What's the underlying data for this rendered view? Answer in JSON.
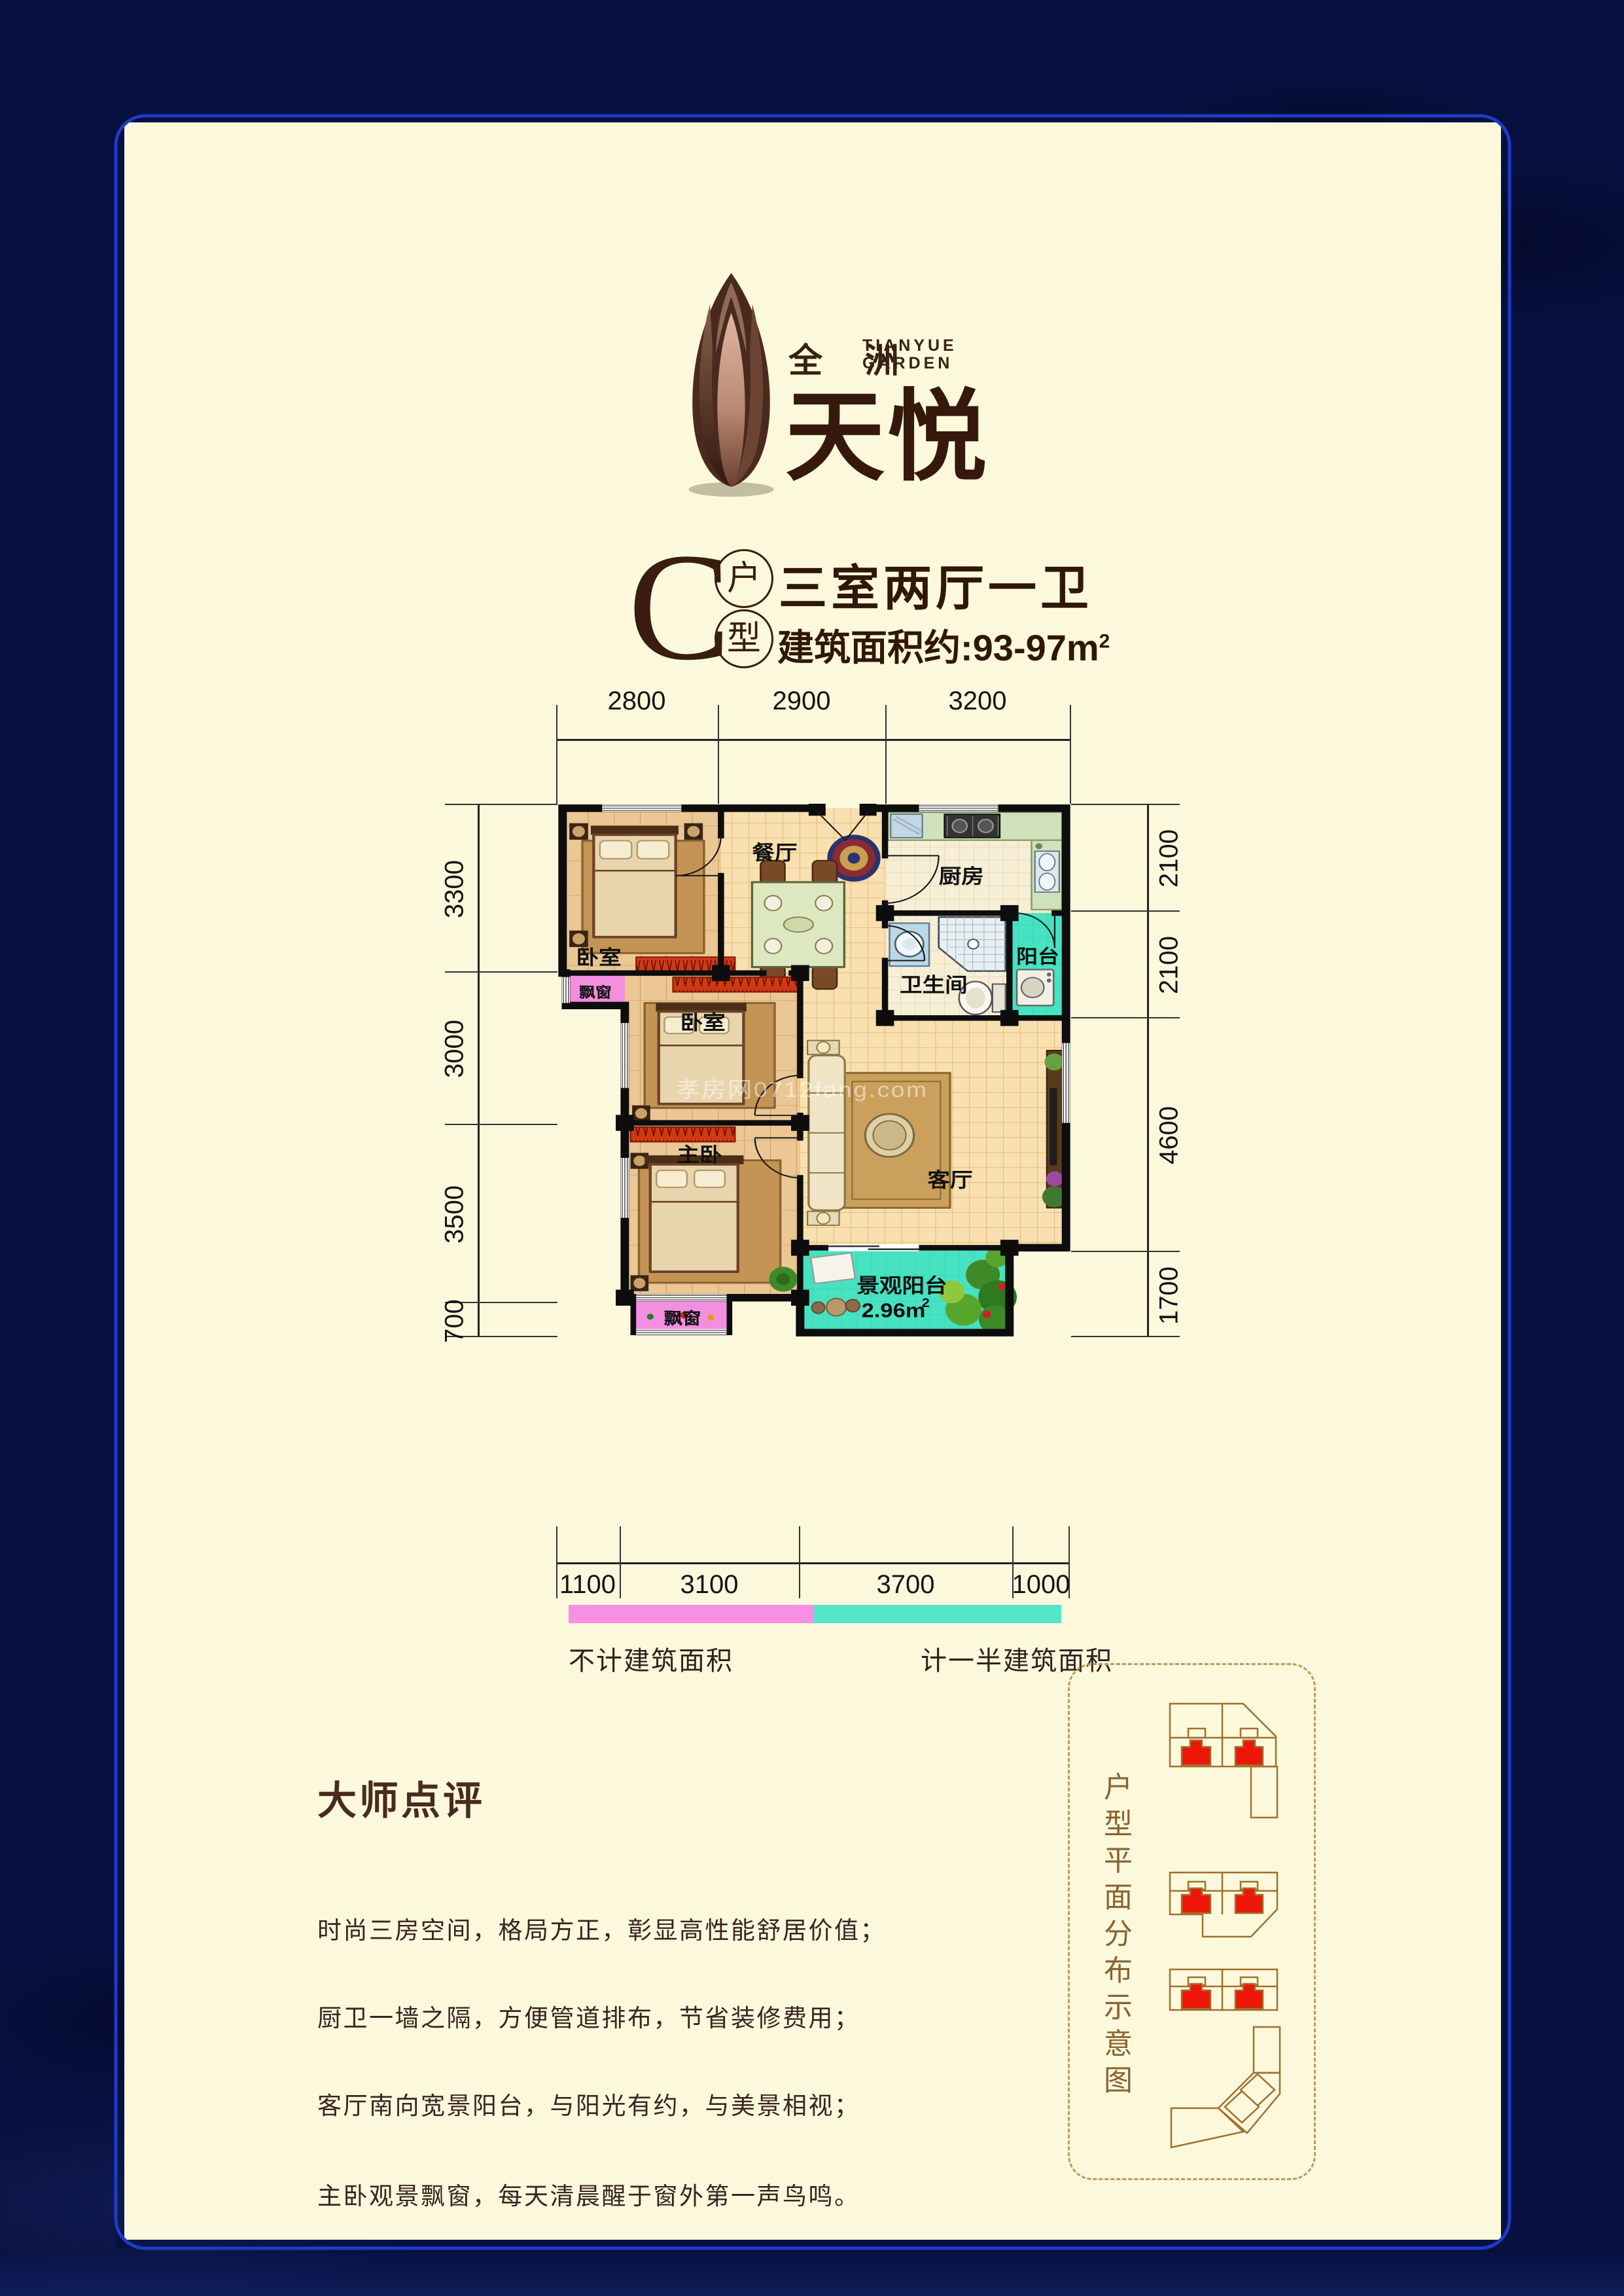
{
  "page": {
    "bg_navy": "#081040",
    "frame_blue": "#1d3cc8",
    "cream": "#fcf8dc"
  },
  "brand": {
    "cn": "全 洲",
    "en_line1": "TIANYUE",
    "en_line2": "GARDEN",
    "name": "天悦"
  },
  "unit": {
    "letter": "C",
    "badge_top": "户",
    "badge_bottom": "型",
    "layout": "三室两厅一卫",
    "area_text": "建筑面积约:93-97m",
    "area_sup": "2"
  },
  "dimensions": {
    "top": [
      "2800",
      "2900",
      "3200"
    ],
    "left": [
      "3300",
      "3000",
      "3500",
      "700"
    ],
    "right": [
      "2100",
      "2100",
      "4600",
      "1700"
    ],
    "bottom": [
      "1100",
      "3100",
      "3700",
      "1000"
    ]
  },
  "rooms": {
    "bedroom1": "卧室",
    "bedroom2": "卧室",
    "master": "主卧",
    "dining": "餐厅",
    "kitchen": "厨房",
    "bathroom": "卫生间",
    "side_balcony": "阳台",
    "living": "客厅",
    "view_balcony": "景观阳台",
    "view_balcony_area": "2.96m",
    "view_balcony_area_sup": "2",
    "bay_window_top": "飘窗",
    "bay_window_bottom": "飘窗"
  },
  "legend": {
    "pink_color": "#f78fe3",
    "teal_color": "#54e6c9",
    "pink_label": "不计建筑面积",
    "teal_label": "计一半建筑面积"
  },
  "watermark": "孝房网0712fang.com",
  "review": {
    "title": "大师点评",
    "lines": [
      "时尚三房空间，格局方正，彰显高性能舒居价值；",
      "厨卫一墙之隔，方便管道排布，节省装修费用；",
      "客厅南向宽景阳台，与阳光有约，与美景相视；",
      "主卧观景飘窗，每天清晨醒于窗外第一声鸟鸣。"
    ]
  },
  "sidebar": {
    "vertical_title": "户型平面分布示意图"
  }
}
